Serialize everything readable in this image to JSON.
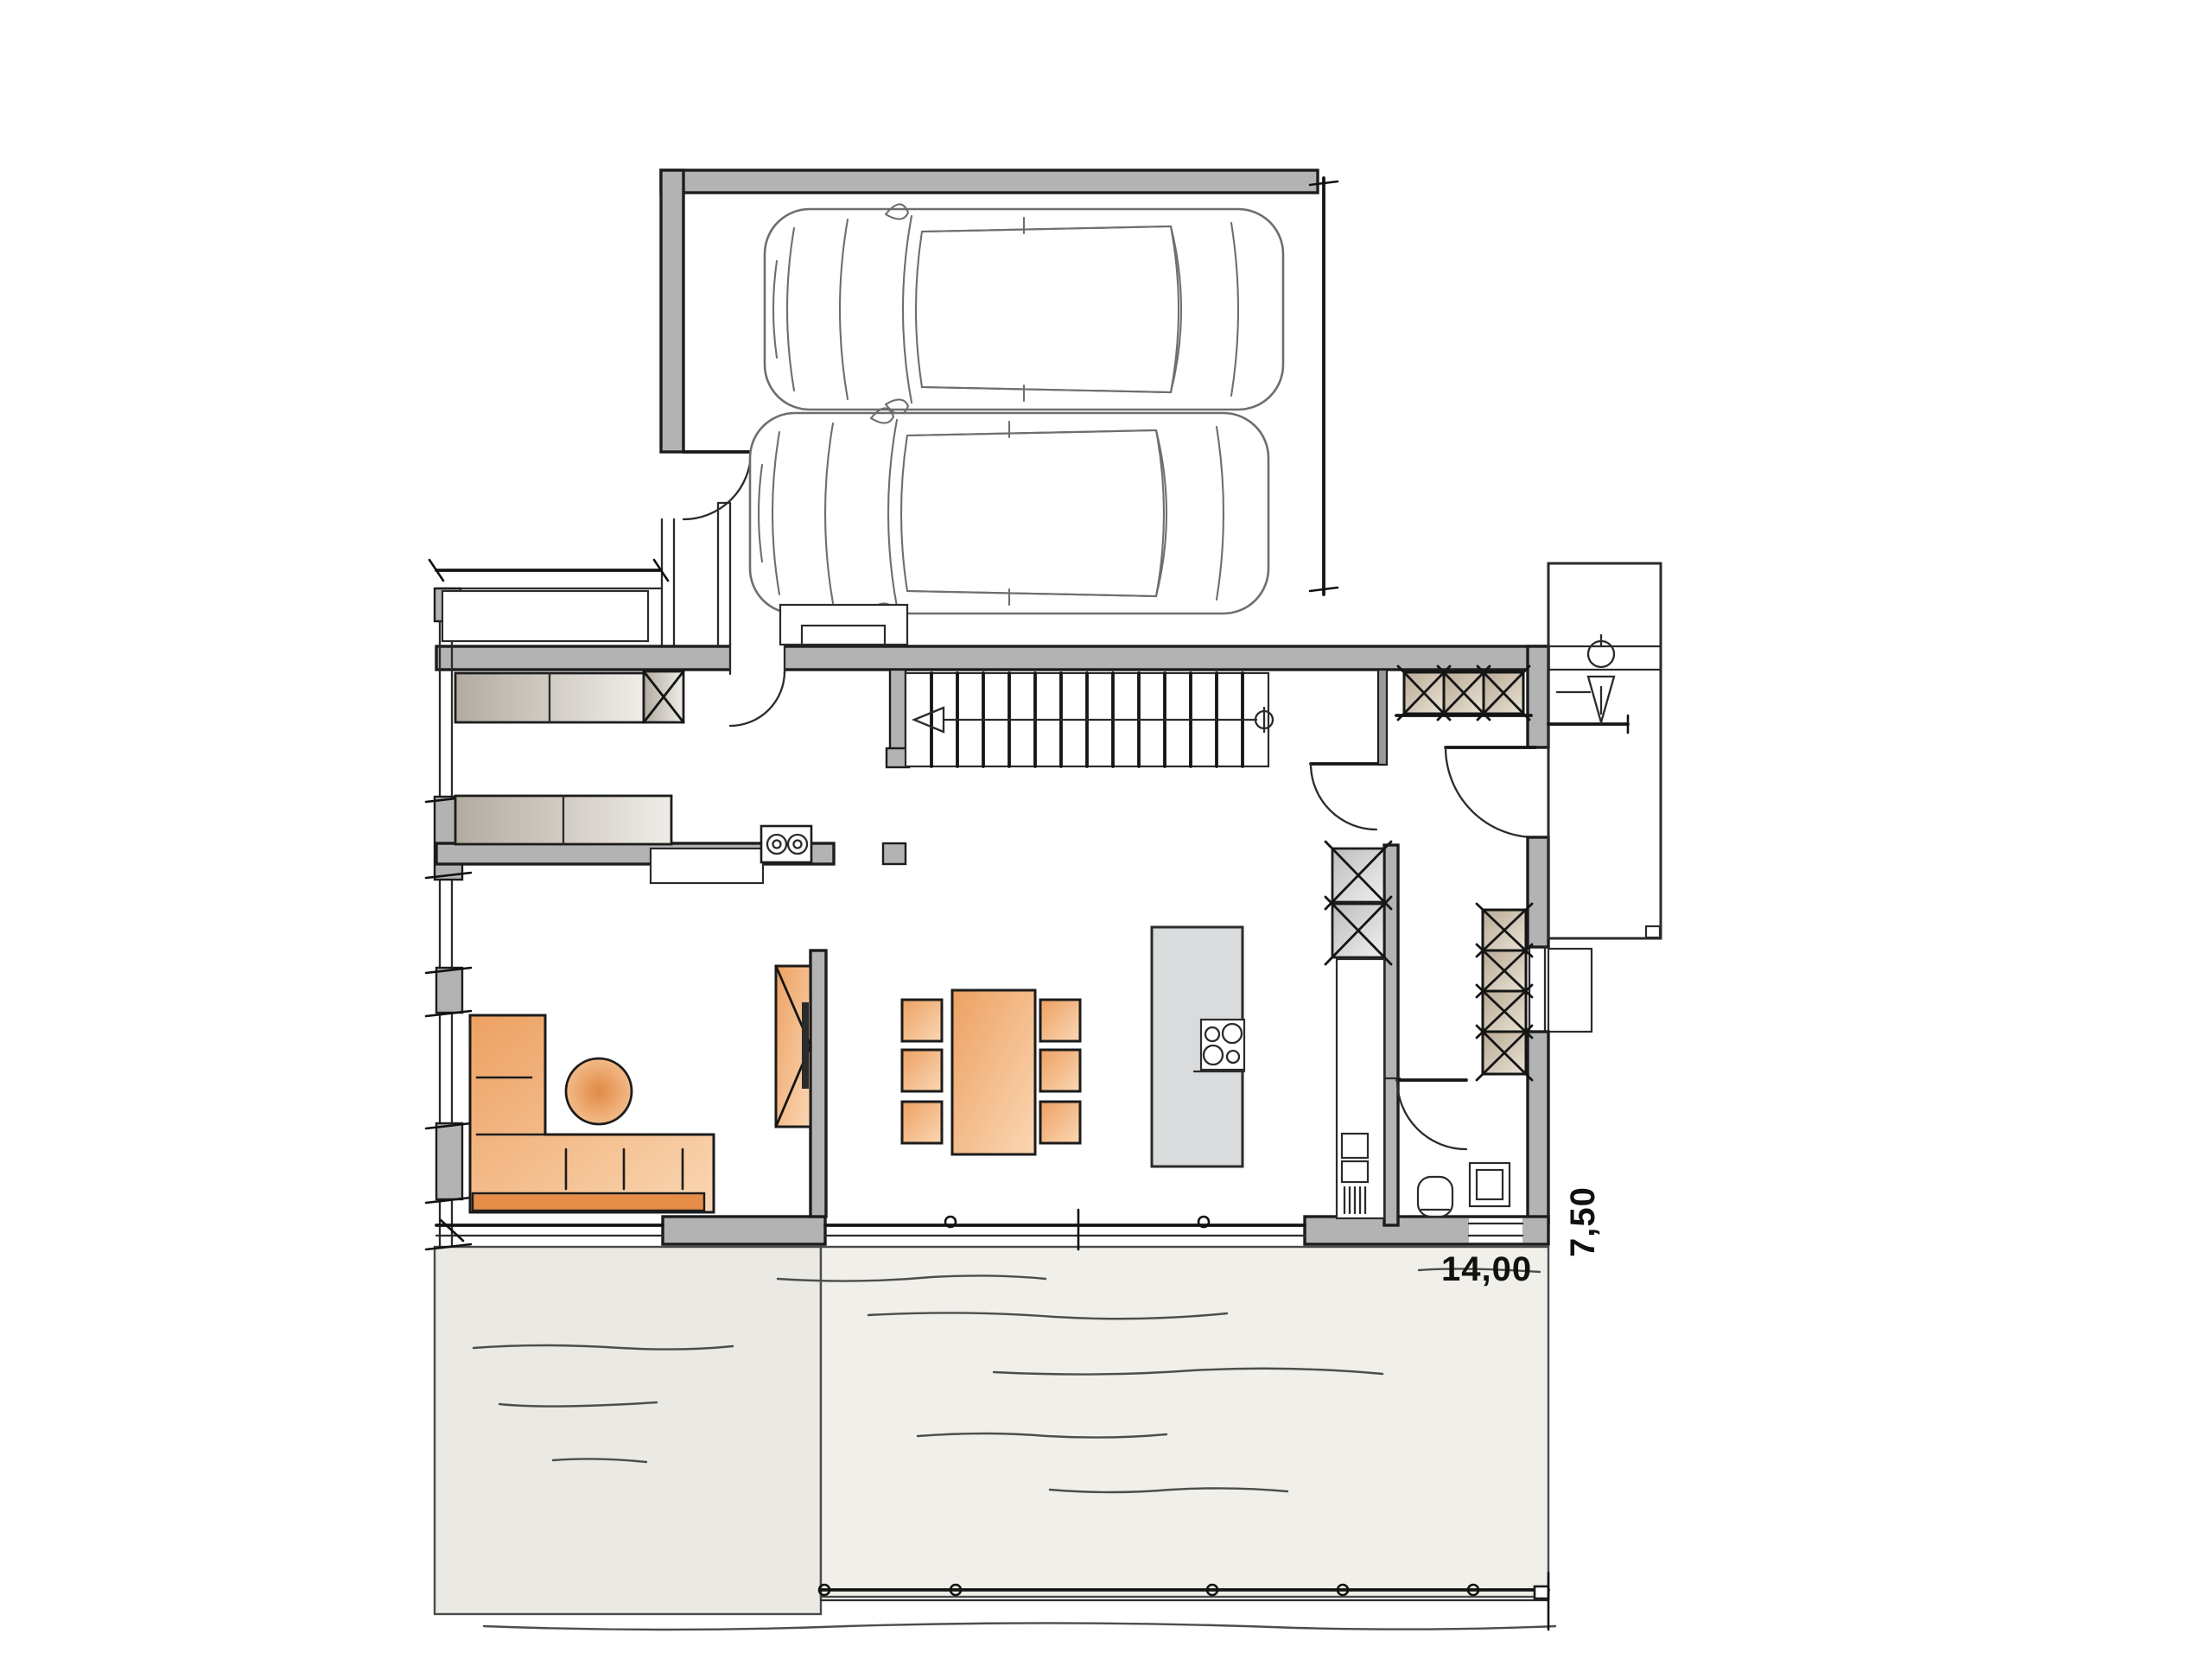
{
  "page": {
    "type": "architectural floor plan, hand-sketch style",
    "view": "ground floor with double garage, open living space and terrace",
    "background": "#ffffff"
  },
  "labels": {
    "terrace_width": "14,00",
    "terrace_depth": "7,50"
  },
  "colors": {
    "wall": "#b3b3b3",
    "outline": "#1c1c1c",
    "island": "#d9dbdd",
    "terrace_left": "#ebe9e3",
    "terrace_main": "#f1efe9",
    "furniture_orange": "#efa265",
    "furniture_orange_dark": "#e58d49",
    "cabinet_tan": "#c3b4a0",
    "sketch_gray": "#6e6e6e"
  },
  "objects": [
    "garage",
    "car",
    "garage-door-edge",
    "house-shell",
    "window-band",
    "pantry-shelving",
    "appliance-box",
    "pantry-counter",
    "twin-sink-unit",
    "staircase",
    "stair-direction-arrow",
    "stair-newel-post",
    "entrance-door",
    "entrance-canopy",
    "person-figure",
    "doormat-step",
    "wardrobe-closet",
    "hall-tall-cabinet",
    "kitchen-tall-cabinet",
    "kitchen-counter",
    "kitchen-sink",
    "kitchen-island",
    "cooktop",
    "dining-table",
    "dining-chair",
    "l-shaped-sofa",
    "round-side-table",
    "tv-sideboard",
    "partition-wall",
    "wc-toilet",
    "wc-washbasin",
    "window-front",
    "terrace",
    "terrace-railing",
    "door-swing",
    "window-bay"
  ]
}
